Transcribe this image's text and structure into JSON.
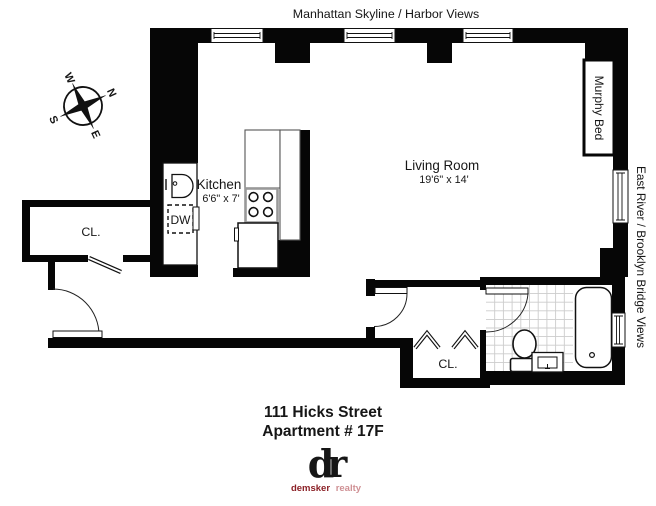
{
  "title_top": "Manhattan Skyline / Harbor Views",
  "side_label": "East River / Brooklyn Bridge Views",
  "rooms": {
    "living": {
      "name": "Living Room",
      "dims": "19'6\" x 14'"
    },
    "kitchen": {
      "name": "Kitchen",
      "dims": "6'6\" x 7'"
    },
    "closet1": "CL.",
    "closet2": "CL.",
    "murphy_bed": "Murphy Bed",
    "dishwasher": "DW"
  },
  "compass": {
    "n": "N",
    "e": "E",
    "s": "S",
    "w": "W"
  },
  "address": {
    "line1": "111 Hicks Street",
    "line2": "Apartment # 17F"
  },
  "brand": {
    "monogram": "dr",
    "name": "demsker",
    "suffix": "realty",
    "color_dark": "#8b2026",
    "color_light": "#cf9094"
  },
  "colors": {
    "wall": "#060606",
    "tile_line": "#cccccc",
    "cabinet_line": "#555555",
    "stove_line": "#999999"
  }
}
